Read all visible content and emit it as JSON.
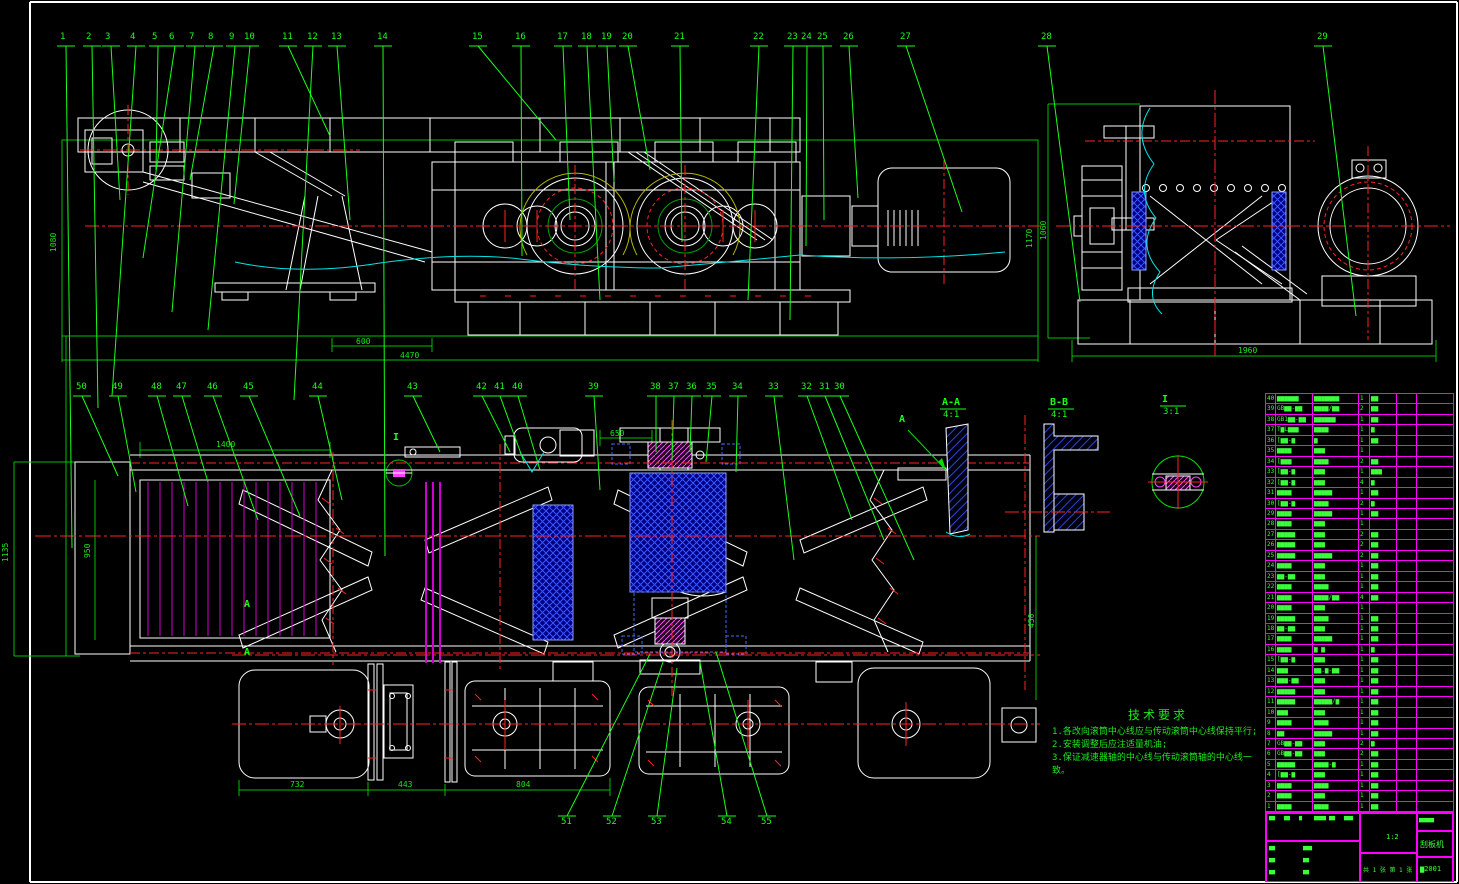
{
  "drawing": {
    "tech_req": {
      "title": "技术要求",
      "items": [
        "1.各改向滚筒中心线应与传动滚筒中心线保持平行;",
        "2.安装调整后应注适量机油;",
        "3.保证减速器轴的中心线与传动滚筒轴的中心线一致。"
      ]
    },
    "sections": [
      {
        "label": "A-A",
        "scale": "4:1",
        "x": 942,
        "y": 398
      },
      {
        "label": "B-B",
        "scale": "4:1",
        "x": 1050,
        "y": 398
      },
      {
        "label": "I",
        "scale": "3:1",
        "x": 1162,
        "y": 395
      }
    ],
    "markers": [
      {
        "label": "I",
        "x": 393,
        "y": 433
      },
      {
        "label": "A",
        "x": 899,
        "y": 415
      },
      {
        "label": "A",
        "x": 244,
        "y": 600
      },
      {
        "label": "A",
        "x": 244,
        "y": 648
      }
    ],
    "dims": [
      {
        "v": "1080",
        "x": 50,
        "y": 252,
        "rot": true
      },
      {
        "v": "600",
        "x": 356,
        "y": 338,
        "rot": false
      },
      {
        "v": "4470",
        "x": 400,
        "y": 352,
        "rot": false
      },
      {
        "v": "1170",
        "x": 1026,
        "y": 248,
        "rot": true
      },
      {
        "v": "1060",
        "x": 1040,
        "y": 240,
        "rot": true
      },
      {
        "v": "1960",
        "x": 1238,
        "y": 347,
        "rot": false
      },
      {
        "v": "1400",
        "x": 216,
        "y": 441,
        "rot": false
      },
      {
        "v": "1135",
        "x": 2,
        "y": 562,
        "rot": true
      },
      {
        "v": "950",
        "x": 84,
        "y": 558,
        "rot": true
      },
      {
        "v": "650",
        "x": 610,
        "y": 430,
        "rot": false
      },
      {
        "v": "450",
        "x": 1028,
        "y": 628,
        "rot": true
      },
      {
        "v": "732",
        "x": 290,
        "y": 781,
        "rot": false
      },
      {
        "v": "443",
        "x": 398,
        "y": 781,
        "rot": false
      },
      {
        "v": "804",
        "x": 516,
        "y": 781,
        "rot": false
      }
    ],
    "callouts_top": {
      "y": 33,
      "base": 46,
      "items": [
        {
          "n": "1",
          "x": 60,
          "tx": 72,
          "ty": 548
        },
        {
          "n": "2",
          "x": 86,
          "tx": 98,
          "ty": 408
        },
        {
          "n": "3",
          "x": 105,
          "tx": 120,
          "ty": 200
        },
        {
          "n": "4",
          "x": 130,
          "tx": 112,
          "ty": 396
        },
        {
          "n": "5",
          "x": 152,
          "tx": 156,
          "ty": 170
        },
        {
          "n": "6",
          "x": 169,
          "tx": 143,
          "ty": 258
        },
        {
          "n": "7",
          "x": 189,
          "tx": 172,
          "ty": 312
        },
        {
          "n": "8",
          "x": 208,
          "tx": 190,
          "ty": 180
        },
        {
          "n": "9",
          "x": 229,
          "tx": 208,
          "ty": 330
        },
        {
          "n": "10",
          "x": 244,
          "tx": 234,
          "ty": 204
        },
        {
          "n": "11",
          "x": 282,
          "tx": 330,
          "ty": 136
        },
        {
          "n": "12",
          "x": 307,
          "tx": 294,
          "ty": 400
        },
        {
          "n": "13",
          "x": 331,
          "tx": 350,
          "ty": 220
        },
        {
          "n": "14",
          "x": 377,
          "tx": 385,
          "ty": 556
        },
        {
          "n": "15",
          "x": 472,
          "tx": 556,
          "ty": 140
        },
        {
          "n": "16",
          "x": 515,
          "tx": 522,
          "ty": 256
        },
        {
          "n": "17",
          "x": 557,
          "tx": 570,
          "ty": 220
        },
        {
          "n": "18",
          "x": 581,
          "tx": 600,
          "ty": 300
        },
        {
          "n": "19",
          "x": 601,
          "tx": 614,
          "ty": 182
        },
        {
          "n": "20",
          "x": 622,
          "tx": 650,
          "ty": 170
        },
        {
          "n": "21",
          "x": 674,
          "tx": 682,
          "ty": 242
        },
        {
          "n": "22",
          "x": 753,
          "tx": 748,
          "ty": 300
        },
        {
          "n": "23",
          "x": 787,
          "tx": 790,
          "ty": 320
        },
        {
          "n": "24",
          "x": 801,
          "tx": 806,
          "ty": 246
        },
        {
          "n": "25",
          "x": 817,
          "tx": 824,
          "ty": 220
        },
        {
          "n": "26",
          "x": 843,
          "tx": 858,
          "ty": 198
        },
        {
          "n": "27",
          "x": 900,
          "tx": 962,
          "ty": 212
        },
        {
          "n": "28",
          "x": 1041,
          "tx": 1080,
          "ty": 302
        },
        {
          "n": "29",
          "x": 1317,
          "tx": 1356,
          "ty": 316
        }
      ]
    },
    "callouts_mid": {
      "y": 383,
      "base": 396,
      "items": [
        {
          "n": "50",
          "x": 76,
          "tx": 118,
          "ty": 476
        },
        {
          "n": "49",
          "x": 112,
          "tx": 136,
          "ty": 492
        },
        {
          "n": "48",
          "x": 151,
          "tx": 188,
          "ty": 506
        },
        {
          "n": "47",
          "x": 176,
          "tx": 208,
          "ty": 482
        },
        {
          "n": "46",
          "x": 207,
          "tx": 258,
          "ty": 520
        },
        {
          "n": "45",
          "x": 243,
          "tx": 300,
          "ty": 516
        },
        {
          "n": "44",
          "x": 312,
          "tx": 342,
          "ty": 500
        },
        {
          "n": "43",
          "x": 407,
          "tx": 440,
          "ty": 452
        },
        {
          "n": "42",
          "x": 476,
          "tx": 510,
          "ty": 452
        },
        {
          "n": "41",
          "x": 494,
          "tx": 524,
          "ty": 462
        },
        {
          "n": "40",
          "x": 512,
          "tx": 540,
          "ty": 470
        },
        {
          "n": "39",
          "x": 588,
          "tx": 600,
          "ty": 490
        },
        {
          "n": "38",
          "x": 650,
          "tx": 656,
          "ty": 452
        },
        {
          "n": "37",
          "x": 668,
          "tx": 672,
          "ty": 460
        },
        {
          "n": "36",
          "x": 686,
          "tx": 690,
          "ty": 452
        },
        {
          "n": "35",
          "x": 706,
          "tx": 706,
          "ty": 462
        },
        {
          "n": "34",
          "x": 732,
          "tx": 736,
          "ty": 472
        },
        {
          "n": "33",
          "x": 768,
          "tx": 794,
          "ty": 560
        },
        {
          "n": "32",
          "x": 801,
          "tx": 852,
          "ty": 520
        },
        {
          "n": "31",
          "x": 819,
          "tx": 884,
          "ty": 540
        },
        {
          "n": "30",
          "x": 834,
          "tx": 914,
          "ty": 560
        }
      ]
    },
    "callouts_bottom": {
      "y": 818,
      "base": 816,
      "items": [
        {
          "n": "51",
          "x": 561,
          "tx": 650,
          "ty": 654
        },
        {
          "n": "52",
          "x": 606,
          "tx": 663,
          "ty": 662
        },
        {
          "n": "53",
          "x": 651,
          "tx": 677,
          "ty": 668
        },
        {
          "n": "54",
          "x": 721,
          "tx": 700,
          "ty": 662
        },
        {
          "n": "55",
          "x": 761,
          "tx": 716,
          "ty": 652
        }
      ]
    }
  },
  "bom": {
    "rows": [
      [
        "40",
        "▆▆▆▆▆▆",
        "▆▆▆▆▆▆▆",
        "1",
        "▆▆",
        ""
      ],
      [
        "39",
        "GB▆▆-▆▆",
        "▆▆▆▆/▆▆",
        "2",
        "▆▆",
        ""
      ],
      [
        "38",
        "GB1▆▆-▆▆",
        "▆▆▆▆▆▆",
        "1",
        "▆▆",
        ""
      ],
      [
        "37",
        "T▆L▆▆▆",
        "▆▆▆▆",
        "1",
        "▆",
        ""
      ],
      [
        "36",
        "[▆▆-▆",
        "▆",
        "1",
        "▆▆",
        ""
      ],
      [
        "35",
        "▆▆▆▆",
        "▆▆▆",
        "1",
        "",
        ""
      ],
      [
        "34",
        "[▆▆▆",
        "▆▆▆▆",
        "2",
        "▆▆",
        ""
      ],
      [
        "33",
        "[▆▆-▆",
        "▆▆▆",
        "1",
        "▆▆▆",
        ""
      ],
      [
        "32",
        "[▆▆-▆",
        "▆▆▆",
        "4",
        "▆",
        ""
      ],
      [
        "31",
        "▆▆▆▆",
        "▆▆▆▆▆",
        "1",
        "▆▆",
        ""
      ],
      [
        "30",
        "[▆▆-▆",
        "▆▆▆▆",
        "2",
        "▆",
        ""
      ],
      [
        "29",
        "▆▆▆▆",
        "▆▆▆▆▆",
        "1",
        "▆▆",
        ""
      ],
      [
        "28",
        "▆▆▆▆",
        "▆▆▆",
        "1",
        "",
        ""
      ],
      [
        "27",
        "▆▆▆▆▆",
        "▆▆▆",
        "2",
        "▆▆",
        ""
      ],
      [
        "26",
        "▆▆▆▆▆",
        "▆▆▆",
        "2",
        "▆▆",
        ""
      ],
      [
        "25",
        "▆▆▆▆▆",
        "▆▆▆▆▆",
        "2",
        "▆▆",
        ""
      ],
      [
        "24",
        "▆▆▆▆",
        "▆▆▆",
        "1",
        "▆▆",
        ""
      ],
      [
        "23",
        "▆▆-▆▆",
        "▆▆▆",
        "1",
        "▆▆",
        ""
      ],
      [
        "22",
        "▆▆▆▆",
        "▆▆▆▆",
        "1",
        "▆▆",
        ""
      ],
      [
        "21",
        "▆▆▆▆",
        "▆▆▆▆/▆▆",
        "4",
        "▆▆",
        ""
      ],
      [
        "20",
        "▆▆▆▆",
        "▆▆▆",
        "1",
        "",
        ""
      ],
      [
        "19",
        "▆▆▆▆▆",
        "▆▆▆▆",
        "1",
        "▆▆",
        ""
      ],
      [
        "18",
        "▆▆-▆▆",
        "▆▆▆",
        "1",
        "▆▆",
        ""
      ],
      [
        "17",
        "▆▆▆▆",
        "▆▆▆▆▆",
        "1",
        "▆▆",
        ""
      ],
      [
        "16",
        "▆▆▆▆",
        "▆ ▆",
        "1",
        "▆",
        ""
      ],
      [
        "15",
        "[▆▆-▆",
        "▆▆▆",
        "1",
        "▆▆",
        ""
      ],
      [
        "14",
        "▆▆▆",
        "▆▆.▆-▆▆",
        "1",
        "▆▆",
        ""
      ],
      [
        "13",
        "▆▆▆-▆▆",
        "▆▆▆",
        "1",
        "▆▆",
        ""
      ],
      [
        "12",
        "▆▆▆▆▆",
        "▆▆▆",
        "1",
        "▆▆",
        ""
      ],
      [
        "11",
        "▆▆▆▆▆",
        "▆▆▆▆▆/▆",
        "1",
        "▆▆",
        ""
      ],
      [
        "10",
        "▆▆▆",
        "▆▆▆",
        "1",
        "▆▆",
        ""
      ],
      [
        "9",
        "▆▆▆▆",
        "▆▆▆▆",
        "1",
        "▆▆",
        ""
      ],
      [
        "8",
        "▆▆",
        "▆▆▆▆▆",
        "1",
        "▆▆",
        ""
      ],
      [
        "7",
        "GB▆▆-▆▆",
        "▆▆▆",
        "2",
        "▆",
        ""
      ],
      [
        "6",
        "GB▆▆-▆▆",
        "▆▆▆",
        "2",
        "▆▆",
        ""
      ],
      [
        "5",
        "▆▆▆▆▆",
        "▆▆▆▆-▆",
        "1",
        "▆▆",
        ""
      ],
      [
        "4",
        "[▆▆-▆",
        "▆▆▆",
        "1",
        "▆▆",
        ""
      ],
      [
        "3",
        "▆▆▆▆",
        "▆▆▆▆",
        "1",
        "▆▆",
        ""
      ],
      [
        "2",
        "▆▆▆▆",
        "▆▆▆",
        "1",
        "▆▆",
        ""
      ],
      [
        "1",
        "▆▆▆▆",
        "▆▆▆▆",
        "1",
        "▆▆",
        ""
      ]
    ]
  },
  "title_block": {
    "header_cells": [
      "▆▆",
      "▆▆",
      "▆",
      "▆▆▆▆",
      "▆▆",
      "▆▆▆"
    ],
    "left_small": [
      "▆▆",
      "▆▆▆",
      "▆▆",
      "▆▆",
      "▆▆",
      "▆▆"
    ],
    "scale_value": "1:2",
    "sheet_text": "共 1 张  第 1 张",
    "company": "▆▆▆▆▆",
    "product_name": "刮板机",
    "drawing_no": "▆2001"
  }
}
